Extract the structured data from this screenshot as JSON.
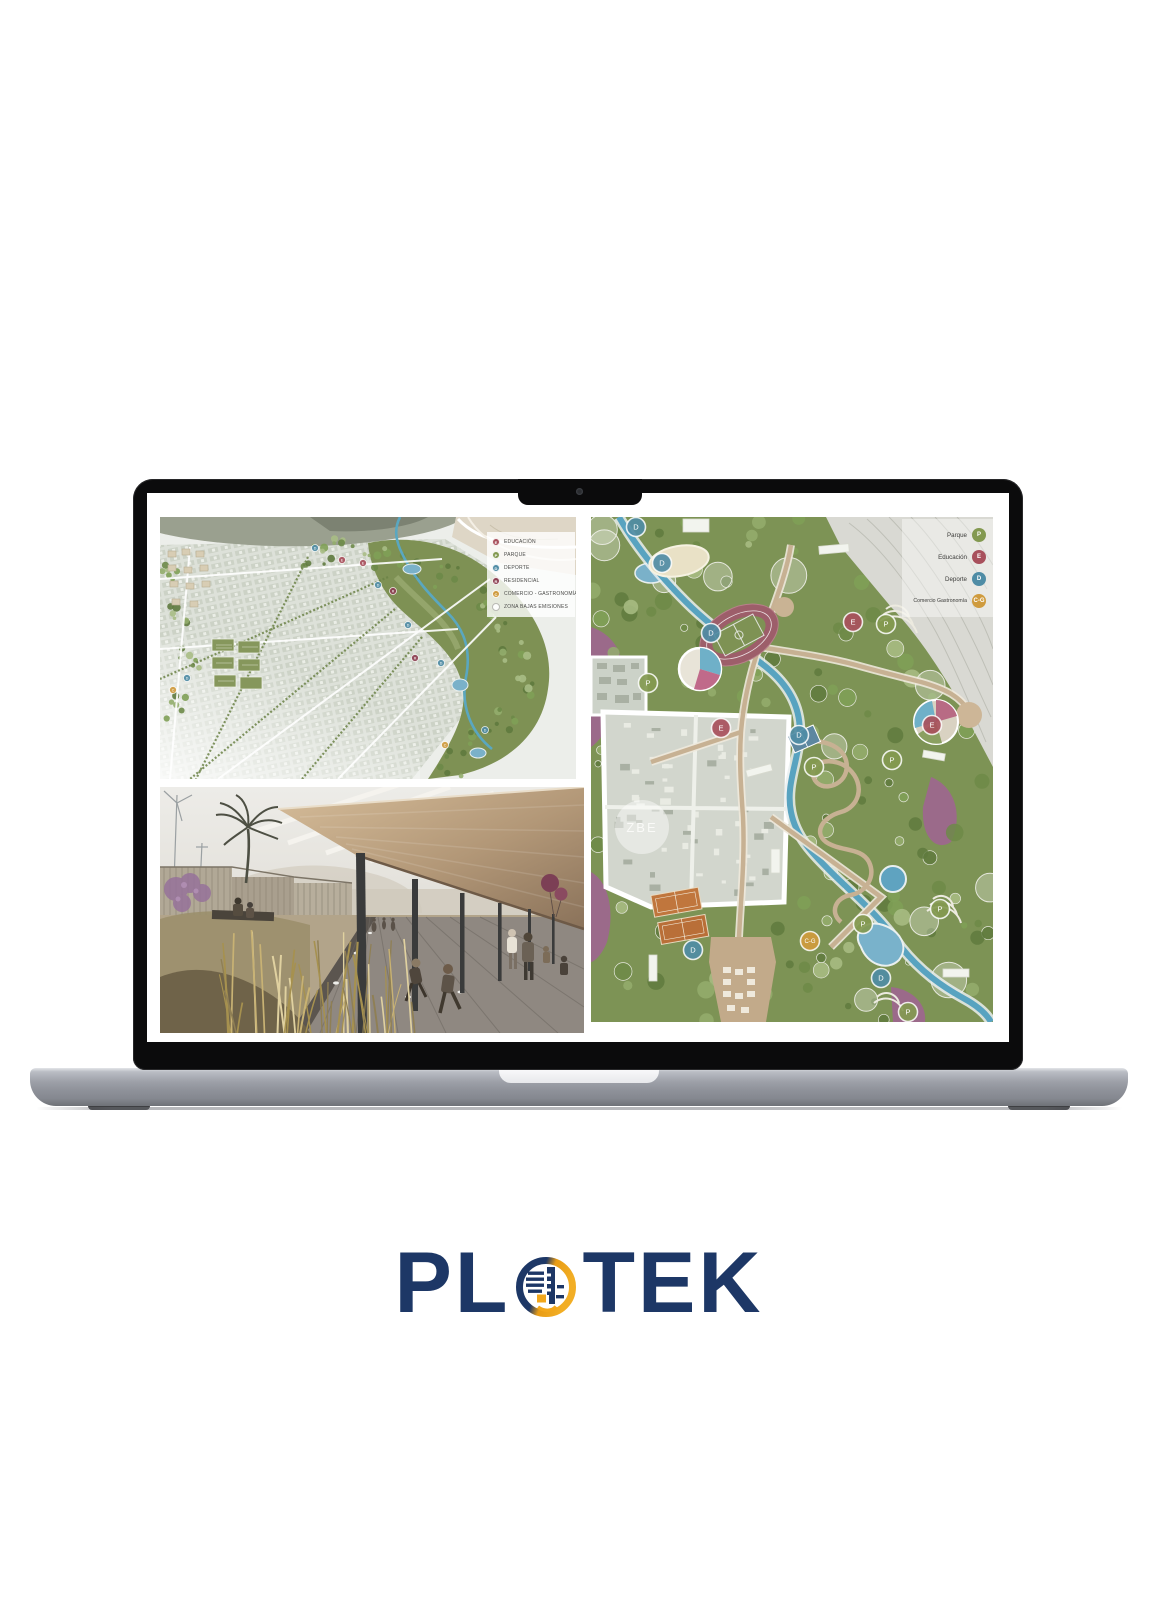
{
  "logo": {
    "prefix": "PL",
    "suffix": "TEK",
    "navy": "#1d3766",
    "gold": "#f2a71b"
  },
  "palette": {
    "parque": "#839950",
    "educacion": "#a8505c",
    "deporte": "#4f8ca5",
    "residencial": "#8d4052",
    "comercio": "#cf9b3e",
    "zbe": "#ffffff"
  },
  "screen": {
    "masterplan_map": {
      "legend": {
        "items": [
          {
            "letter": "E",
            "label": "EDUCACIÓN",
            "type": "educacion"
          },
          {
            "letter": "P",
            "label": "PARQUE",
            "type": "parque"
          },
          {
            "letter": "D",
            "label": "DEPORTE",
            "type": "deporte"
          },
          {
            "letter": "R",
            "label": "RESIDENCIAL",
            "type": "residencial"
          },
          {
            "letter": "C",
            "label": "COMERCIO - GASTRONOMÍA",
            "type": "comercio"
          },
          {
            "letter": "",
            "label": "ZONA BAJAS EMISIONES",
            "type": "zbe"
          }
        ]
      },
      "badges": [
        {
          "letter": "D",
          "type": "deporte",
          "x": 155,
          "y": 31
        },
        {
          "letter": "E",
          "type": "educacion",
          "x": 182,
          "y": 43
        },
        {
          "letter": "E",
          "type": "educacion",
          "x": 203,
          "y": 46
        },
        {
          "letter": "D",
          "type": "deporte",
          "x": 218,
          "y": 68
        },
        {
          "letter": "R",
          "type": "residencial",
          "x": 233,
          "y": 74
        },
        {
          "letter": "D",
          "type": "deporte",
          "x": 248,
          "y": 108
        },
        {
          "letter": "R",
          "type": "residencial",
          "x": 255,
          "y": 141
        },
        {
          "letter": "D",
          "type": "deporte",
          "x": 281,
          "y": 146
        },
        {
          "letter": "D",
          "type": "deporte",
          "x": 325,
          "y": 213
        },
        {
          "letter": "C",
          "type": "comercio",
          "x": 285,
          "y": 228
        },
        {
          "letter": "D",
          "type": "deporte",
          "x": 27,
          "y": 161
        },
        {
          "letter": "C",
          "type": "comercio",
          "x": 13,
          "y": 173
        }
      ]
    },
    "park_map": {
      "legend": {
        "items": [
          {
            "letter": "P",
            "label": "Parque",
            "type": "parque"
          },
          {
            "letter": "E",
            "label": "Educación",
            "type": "educacion"
          },
          {
            "letter": "D",
            "label": "Deporte",
            "type": "deporte"
          },
          {
            "letter": "C-G",
            "label": "Comercio Gastronomía",
            "type": "comercio"
          }
        ]
      },
      "zbe_label": "ZBE",
      "badges": [
        {
          "letter": "D",
          "type": "deporte",
          "x": 45,
          "y": 10
        },
        {
          "letter": "D",
          "type": "deporte",
          "x": 71,
          "y": 46
        },
        {
          "letter": "P",
          "type": "parque",
          "x": 57,
          "y": 166
        },
        {
          "letter": "D",
          "type": "deporte",
          "x": 120,
          "y": 116
        },
        {
          "letter": "E",
          "type": "educacion",
          "x": 262,
          "y": 105
        },
        {
          "letter": "P",
          "type": "parque",
          "x": 295,
          "y": 107
        },
        {
          "letter": "E",
          "type": "educacion",
          "x": 130,
          "y": 211
        },
        {
          "letter": "D",
          "type": "deporte",
          "x": 208,
          "y": 218
        },
        {
          "letter": "E",
          "type": "educacion",
          "x": 341,
          "y": 208
        },
        {
          "letter": "P",
          "type": "parque",
          "x": 301,
          "y": 243
        },
        {
          "letter": "P",
          "type": "parque",
          "x": 223,
          "y": 250
        },
        {
          "letter": "P",
          "type": "parque",
          "x": 272,
          "y": 407
        },
        {
          "letter": "P",
          "type": "parque",
          "x": 349,
          "y": 392
        },
        {
          "letter": "C-G",
          "type": "comercio",
          "x": 219,
          "y": 424
        },
        {
          "letter": "D",
          "type": "deporte",
          "x": 102,
          "y": 433
        },
        {
          "letter": "D",
          "type": "deporte",
          "x": 290,
          "y": 461
        },
        {
          "letter": "P",
          "type": "parque",
          "x": 317,
          "y": 495
        }
      ]
    }
  }
}
